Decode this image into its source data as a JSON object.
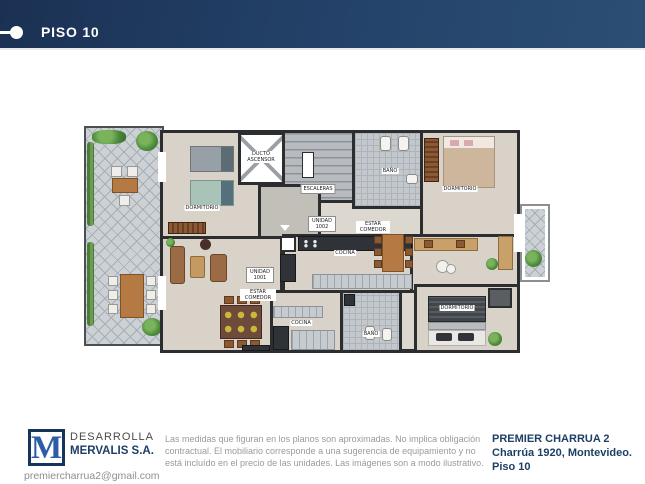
{
  "header": {
    "title": "PISO 10"
  },
  "plan": {
    "labels": {
      "dormitorio_tl": "DORMITORIO",
      "ducto": "DUCTO ASCENSOR",
      "escaleras": "ESCALERAS",
      "bano_top": "BAÑO",
      "dormitorio_tr": "DORMITORIO",
      "unidad_1002": "UNIDAD 1002",
      "estar_comedor_1002": "ESTAR COMEDOR",
      "cocina_1002": "COCINA",
      "unidad_1001": "UNIDAD 1001",
      "estar_comedor_1001": "ESTAR COMEDOR",
      "cocina_1001": "COCINA",
      "bano_bottom": "BAÑO",
      "dormitorio_br": "DORMITORIO"
    }
  },
  "footer": {
    "developer": {
      "logo_letter": "M",
      "line1": "DESARROLLA",
      "line2": "MERVALIS S.A.",
      "email": "premiercharrua2@gmail.com"
    },
    "disclaimer": "Las medidas que figuran en los planos son aproximadas. No implica obligación contractual. El mobiliario corresponde a una sugerencia de equipamiento y no está incluído en el precio de las unidades. Las imágenes son a modo ilustrativo.",
    "property": {
      "name": "PREMIER CHARRUA 2",
      "address": "Charrúa 1920, Montevideo.",
      "floor": "Piso 10"
    }
  },
  "colors": {
    "header_grad_start": "#1b3153",
    "header_grad_end": "#2c4e74",
    "brand_blue": "#2d5ca8",
    "navy_text": "#1d3f66",
    "gray_text": "#9a9a9a"
  }
}
